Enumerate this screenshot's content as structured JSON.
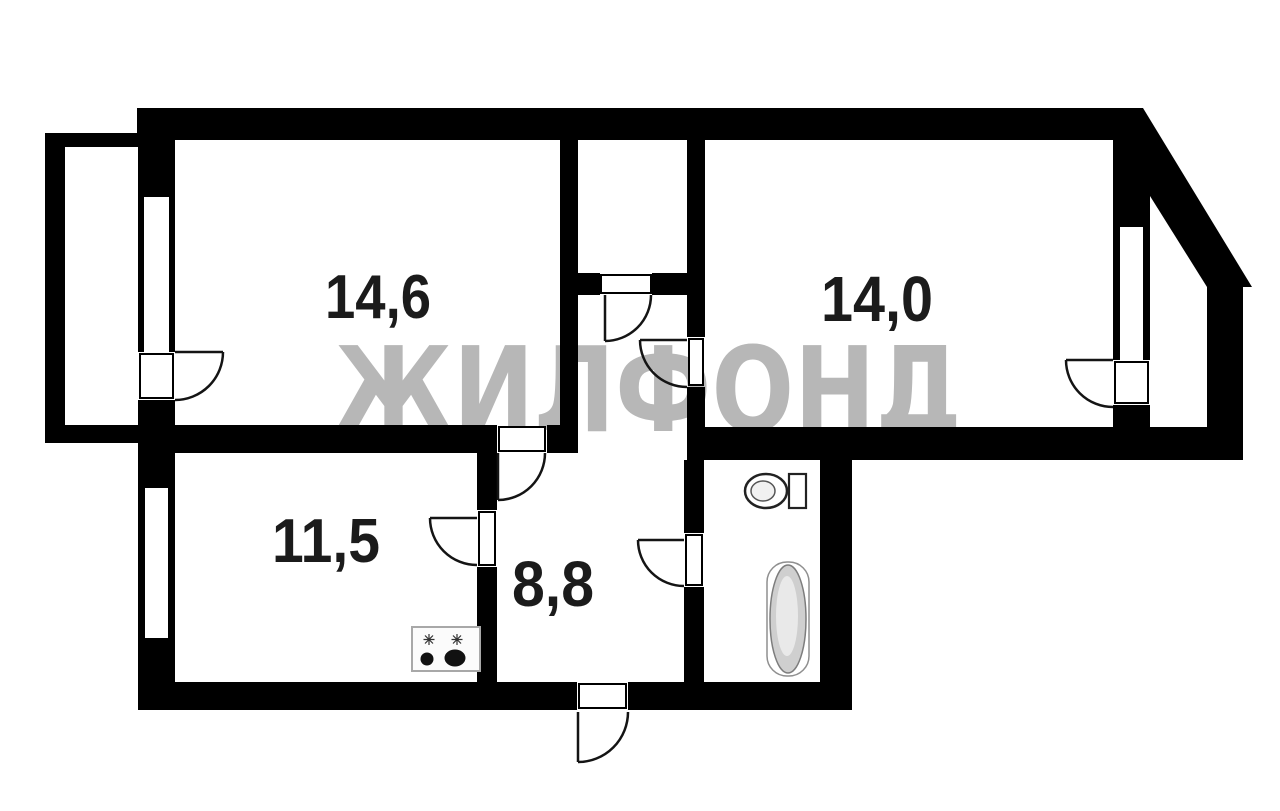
{
  "floor_plan": {
    "watermark_text": "ЖИЛФОНД",
    "background_color": "#ffffff",
    "wall_color": "#000000",
    "watermark_color": "#b5b5b5",
    "rooms": [
      {
        "id": "room-top-left",
        "area_label": "14,6"
      },
      {
        "id": "room-top-right",
        "area_label": "14,0"
      },
      {
        "id": "room-bottom-left",
        "area_label": "11,5"
      },
      {
        "id": "hallway",
        "area_label": "8,8"
      }
    ],
    "fixtures": [
      {
        "icon": "toilet-icon"
      },
      {
        "icon": "bathtub-icon"
      },
      {
        "icon": "stove-icon"
      }
    ]
  }
}
